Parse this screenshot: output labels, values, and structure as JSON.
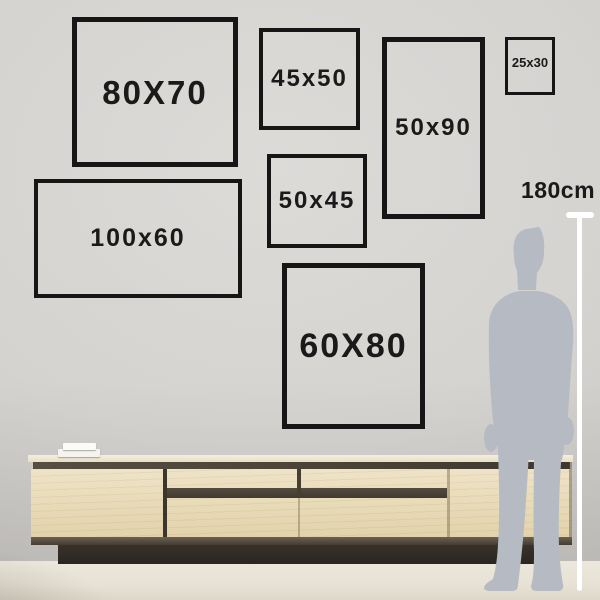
{
  "palette": {
    "wall": "#d6d4d1",
    "floor": "#e8e3d6",
    "frame_border": "#161616",
    "label_text": "#1a1a1a",
    "silhouette": "#b6bbc3",
    "measure_line": "#ffffff",
    "wood_top": "#f0e9d8",
    "wood_body": "#e8dbb9",
    "wood_gap": "#4a4237",
    "plinth": "#322c25"
  },
  "frames": [
    {
      "name": "size-frame-80x70",
      "label": "80X70",
      "x": 72,
      "y": 17,
      "w": 166,
      "h": 150,
      "border": 5,
      "font_px": 33
    },
    {
      "name": "size-frame-45x50",
      "label": "45x50",
      "x": 259,
      "y": 28,
      "w": 101,
      "h": 102,
      "border": 4,
      "font_px": 24
    },
    {
      "name": "size-frame-50x90",
      "label": "50x90",
      "x": 382,
      "y": 37,
      "w": 103,
      "h": 182,
      "border": 5,
      "font_px": 24
    },
    {
      "name": "size-frame-25x30",
      "label": "25x30",
      "x": 505,
      "y": 37,
      "w": 50,
      "h": 58,
      "border": 3,
      "font_px": 13,
      "label_offset_top": 16,
      "letter_spacing": 0
    },
    {
      "name": "size-frame-100x60",
      "label": "100x60",
      "x": 34,
      "y": 179,
      "w": 208,
      "h": 119,
      "border": 4,
      "font_px": 25
    },
    {
      "name": "size-frame-50x45",
      "label": "50x45",
      "x": 267,
      "y": 154,
      "w": 100,
      "h": 94,
      "border": 4,
      "font_px": 24
    },
    {
      "name": "size-frame-60x80",
      "label": "60X80",
      "x": 282,
      "y": 263,
      "w": 143,
      "h": 166,
      "border": 5,
      "font_px": 34
    }
  ],
  "ruler": {
    "label": "180cm"
  }
}
